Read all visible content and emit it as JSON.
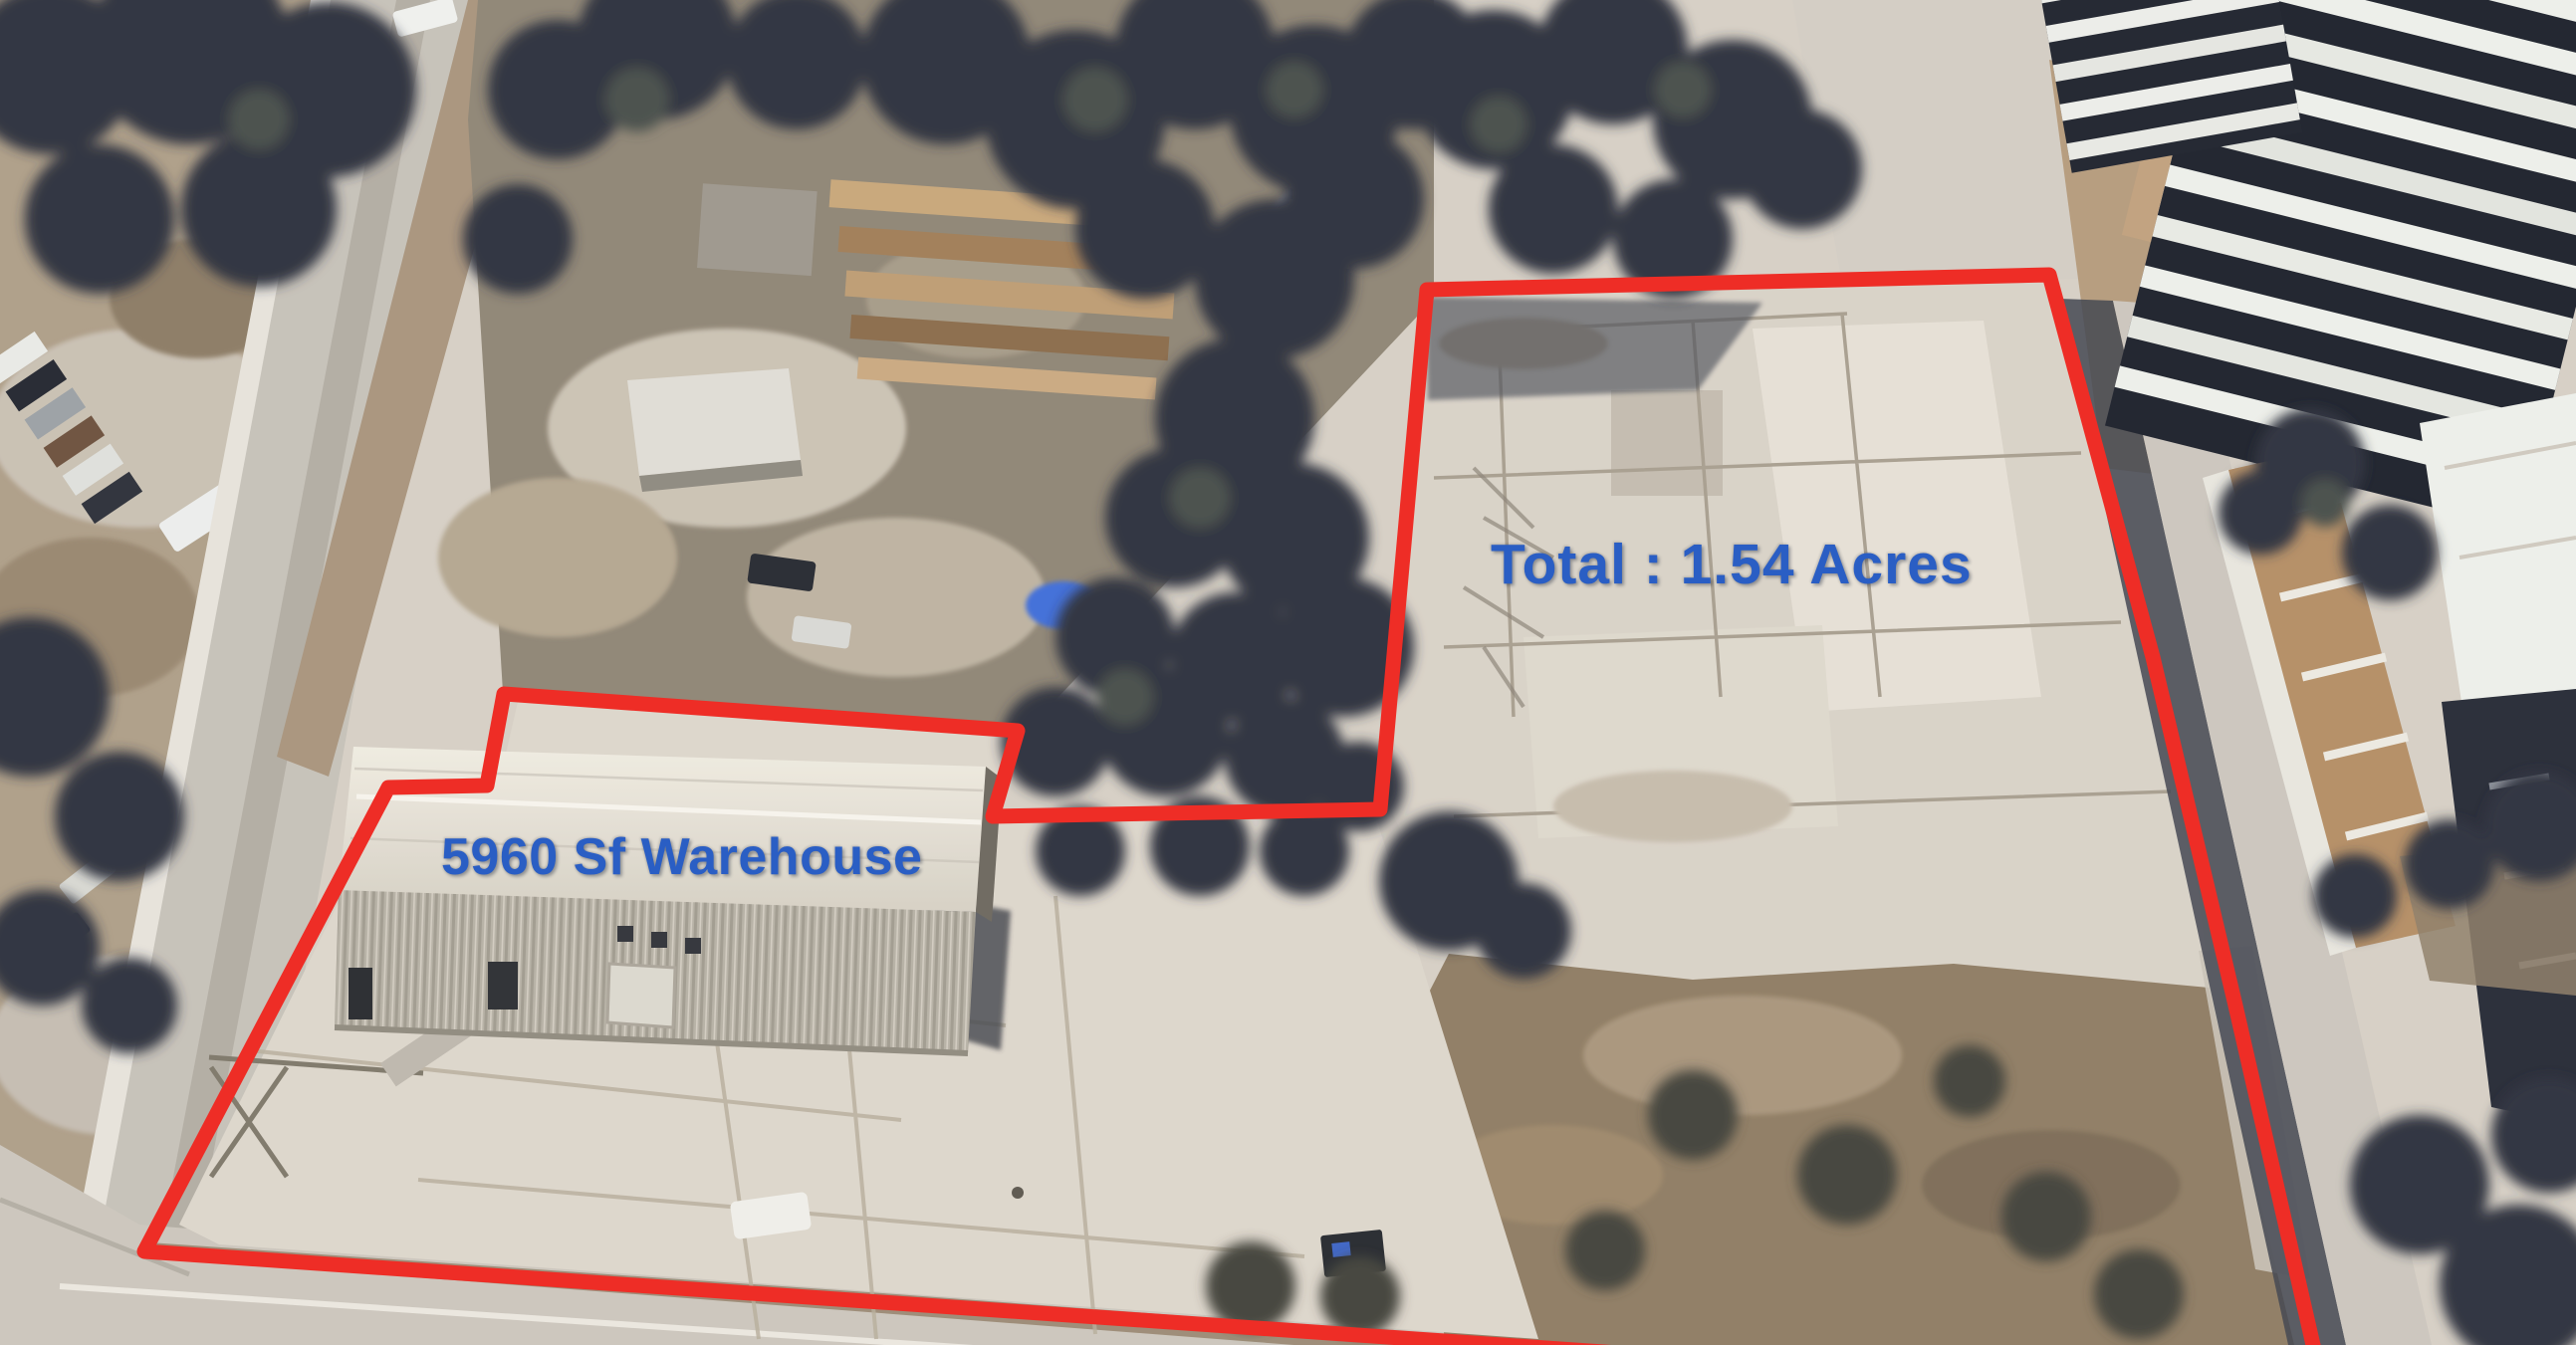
{
  "annotations": {
    "total_area_label": "Total : 1.54 Acres",
    "warehouse_label": "5960 Sf Warehouse"
  },
  "colors": {
    "boundary_red": "#ee2d26",
    "label_blue": "#2a5ec4"
  }
}
